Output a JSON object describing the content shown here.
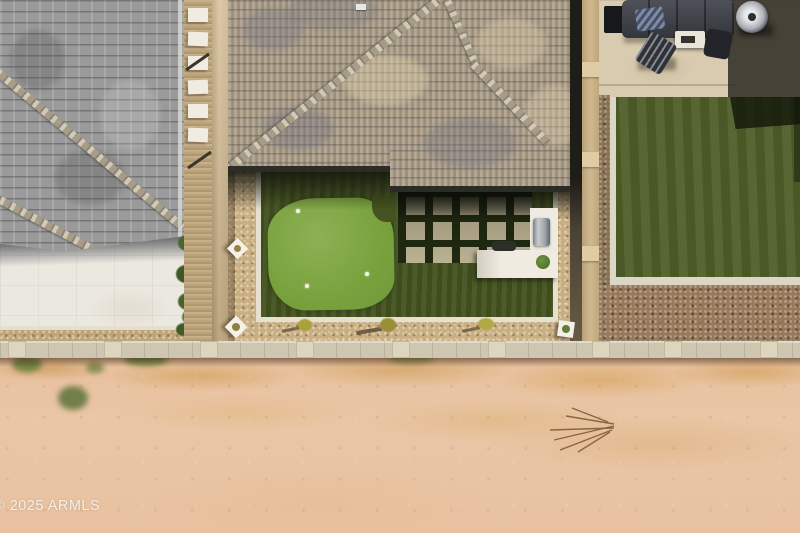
{
  "watermark": {
    "text": "© 2025 ARMLS"
  },
  "colors": {
    "desert_dirt": "#e9c4a2",
    "dry_grass": "#cf9a55",
    "weed_green": "#5e7a33",
    "putting_green": "#7fa842",
    "backyard_turf": "#44531f",
    "neighbor_turf": "#4e5e28",
    "gravel_walkway": "#c9ae81",
    "gravel_shadow_brown": "#97795a",
    "main_roof_tile": "#ab9d86",
    "left_roof_shingle": "#9a9a9a",
    "patio_concrete": "#d8cbb0",
    "white_patio": "#ebe8e0",
    "bbq_counter_white": "#efebe0",
    "grill_stainless": "#b9bcc0",
    "block_wall": "#cfc6b2",
    "side_wall_tan": "#cdb68e",
    "white_curb": "#e6e0d0"
  }
}
